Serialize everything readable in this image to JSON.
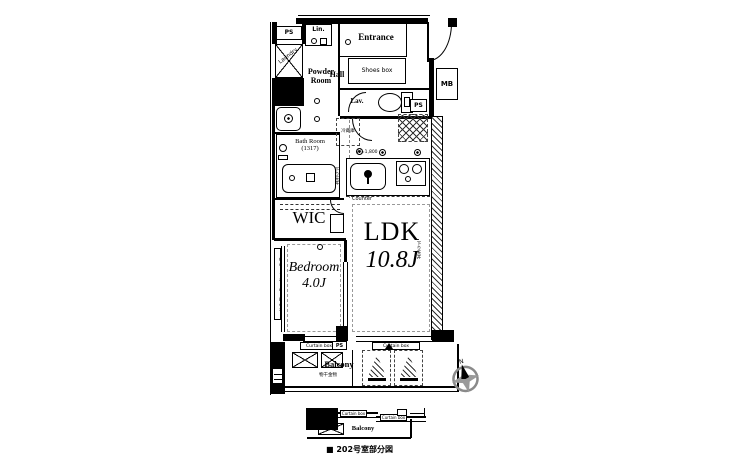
{
  "plan": {
    "rooms": {
      "entrance": "Entrance",
      "hall": "Hall",
      "powder_room": "Powder Room",
      "lavatory": "Lav.",
      "bath_room": "Bath Room (1317)",
      "wic": "WIC",
      "bedroom": "Bedroom",
      "bedroom_size": "4.0J",
      "ldk": "LDK",
      "ldk_size": "10.8J",
      "balcony": "Balcony"
    },
    "labels": {
      "shoes_box": "Shoes box",
      "linen": "Lin.",
      "laundry": "Laundry",
      "meter_box": "MB",
      "pipe_space": "PS",
      "counter": "Counter",
      "counter_width": "W=1,800",
      "curtain_box": "Curtain box",
      "fridge": "冷蔵庫",
      "dropped_ceiling": "下り天井",
      "laundry_pole": "物干金物"
    },
    "compass": {
      "north": "N"
    },
    "partial": {
      "balcony": "Balcony",
      "curtain_box": "Curtain box",
      "caption": "■ 202号室部分図"
    },
    "colors": {
      "wall": "#000000",
      "paper": "#ffffff",
      "compass_gray": "#8a8a8a"
    }
  }
}
